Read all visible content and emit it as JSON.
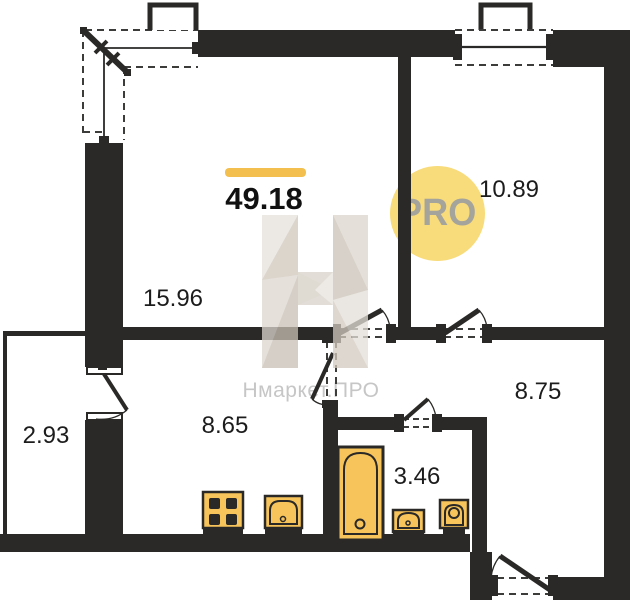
{
  "plan": {
    "title": "apartment-floor-plan",
    "total_area": "49.18",
    "rooms": [
      {
        "name": "living-room",
        "area": "15.96"
      },
      {
        "name": "bedroom",
        "area": "10.89"
      },
      {
        "name": "hallway",
        "area": "8.75"
      },
      {
        "name": "kitchen",
        "area": "8.65"
      },
      {
        "name": "bathroom",
        "area": "3.46"
      },
      {
        "name": "balcony",
        "area": "2.93"
      }
    ],
    "fixtures": [
      "stove-icon",
      "kitchen-sink-icon",
      "bathtub-icon",
      "washbasin-icon",
      "toilet-icon"
    ]
  },
  "badge": {
    "label": "PRO"
  },
  "watermark": {
    "text": "Нмаркет.ПРО"
  },
  "colors": {
    "wall": "#2a2927",
    "accent_bar": "#f3c04f",
    "badge_fill": "#f8db7a",
    "badge_text": "#a5a49c",
    "fixture_fill": "#f7c45b",
    "fixture_stroke": "#2a2927",
    "dash_line": "#3c3c3a",
    "watermark_text": "#c6c6c6"
  }
}
